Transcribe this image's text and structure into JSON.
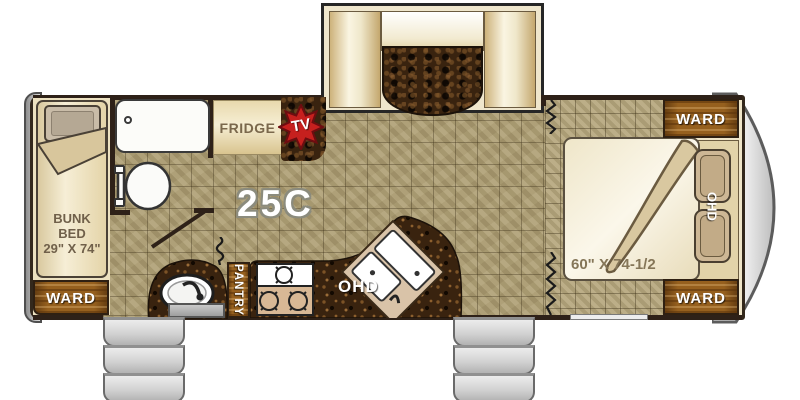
{
  "model": "25C",
  "labels": {
    "bunk_line1": "BUNK",
    "bunk_line2": "BED",
    "bunk_size": "29\" X 74\"",
    "ward_rear": "WARD",
    "ward_front_top": "WARD",
    "ward_front_bottom": "WARD",
    "fridge": "FRIDGE",
    "tv": "TV",
    "pantry": "PANTRY",
    "ohd_kitchen": "OHD",
    "ohd_bedroom": "OHD",
    "bed_size": "60\" X 74-1/2"
  },
  "colors": {
    "wood": "#96601e",
    "counter_granite": "#39230f",
    "tile_main": "#b0a176",
    "tile_bedroom": "#b5a67c",
    "tv_red": "#c6201e",
    "cushion_cream": "#f3ecd4",
    "wall": "#2e2118",
    "steps_gray": "#d2d2d2"
  }
}
